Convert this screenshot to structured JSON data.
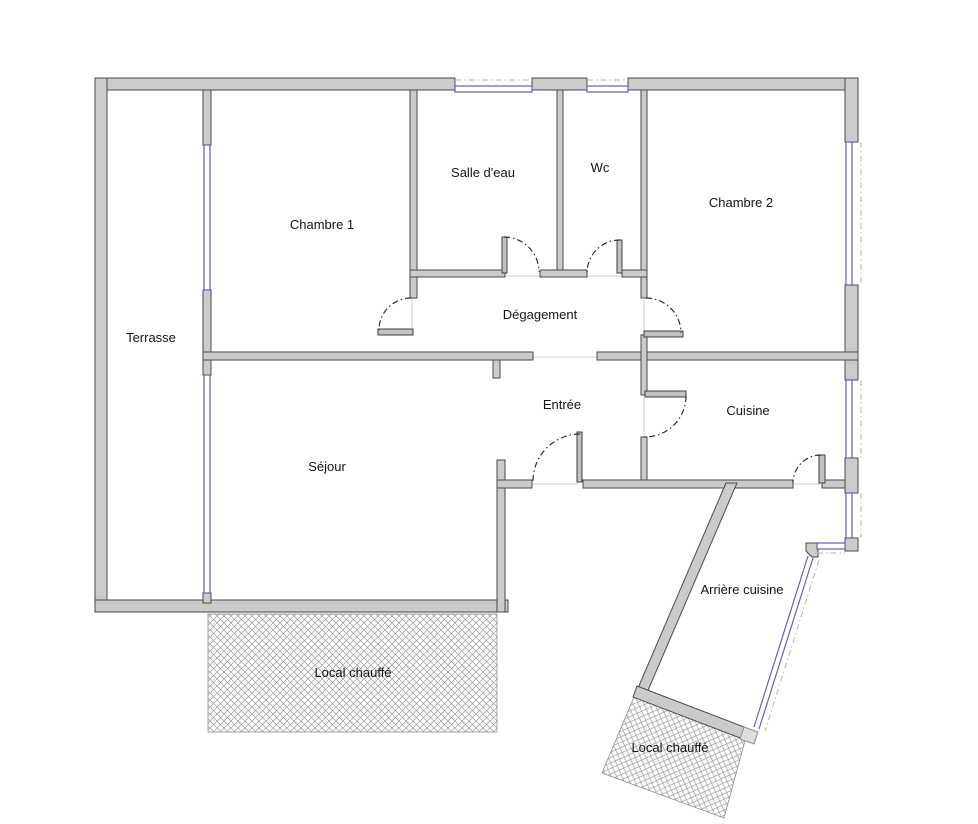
{
  "title": "Plan d'appartement",
  "colors": {
    "wall_gray": "#cbcbcb",
    "wall_outline": "#4a4a4a",
    "window_blue": "#6262b0",
    "hatch_gray": "#8e8e8e",
    "background": "#ffffff"
  },
  "rooms": [
    {
      "id": "terrasse",
      "label": "Terrasse"
    },
    {
      "id": "chambre-1",
      "label": "Chambre 1"
    },
    {
      "id": "salle-d-eau",
      "label": "Salle d'eau"
    },
    {
      "id": "wc",
      "label": "Wc"
    },
    {
      "id": "chambre-2",
      "label": "Chambre 2"
    },
    {
      "id": "degagement",
      "label": "Dégagement"
    },
    {
      "id": "entree",
      "label": "Entrée"
    },
    {
      "id": "cuisine",
      "label": "Cuisine"
    },
    {
      "id": "sejour",
      "label": "Séjour"
    },
    {
      "id": "local-chauffe-1",
      "label": "Local chauffé"
    },
    {
      "id": "arriere-cuisine",
      "label": "Arrière cuisine"
    },
    {
      "id": "local-chauffe-2",
      "label": "Local chauffé"
    }
  ]
}
